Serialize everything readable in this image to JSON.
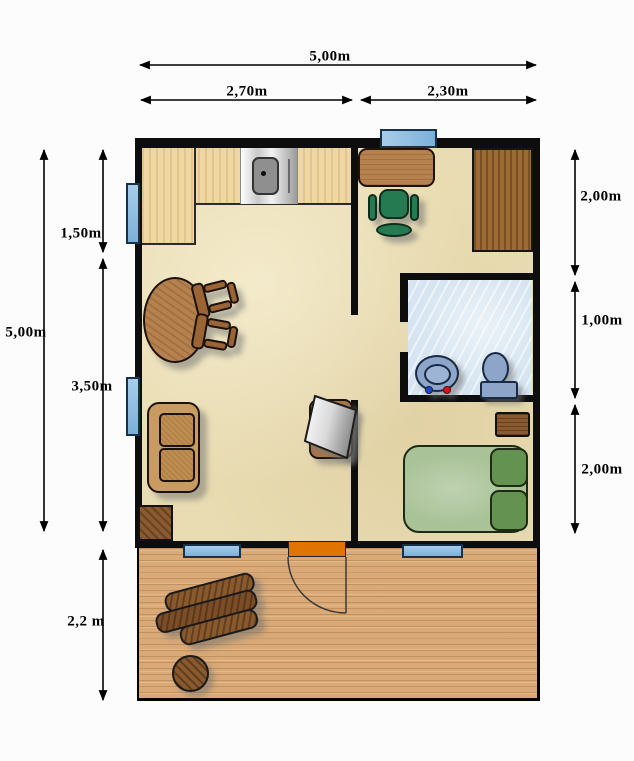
{
  "type": "floor-plan",
  "dimensions": {
    "top": {
      "total": "5,00m",
      "left_section": "2,70m",
      "right_section": "2,30m"
    },
    "left": {
      "total": "5,00m",
      "kitchen": "1,50m",
      "living": "3,50m",
      "deck": "2,2 m"
    },
    "right": {
      "office": "2,00m",
      "bathroom": "1,00m",
      "bedroom": "2,00m"
    }
  },
  "colors": {
    "wall": "#0d0d0d",
    "interior_floor": "#e9dcb2",
    "bathroom_floor": "#d6e5f1",
    "deck_wood": "#d9a977",
    "kitchen_counter": "#eed7a2",
    "window_blue": "#8ab8de",
    "door_orange": "#e07400",
    "bed_green": "#a9c297",
    "pillow_green": "#649250",
    "office_chair_green": "#267a52",
    "furniture_wood": "#8a5a30",
    "fixture_blue": "#8ca5c9"
  },
  "furniture": [
    "kitchen-counter",
    "stove",
    "dining-table",
    "dining-chairs",
    "sofa",
    "tv",
    "corner-cabinet",
    "desk",
    "office-chair",
    "wardrobe",
    "washbasin",
    "toilet",
    "nightstand",
    "double-bed",
    "bench",
    "round-table",
    "entry-door",
    "windows"
  ]
}
